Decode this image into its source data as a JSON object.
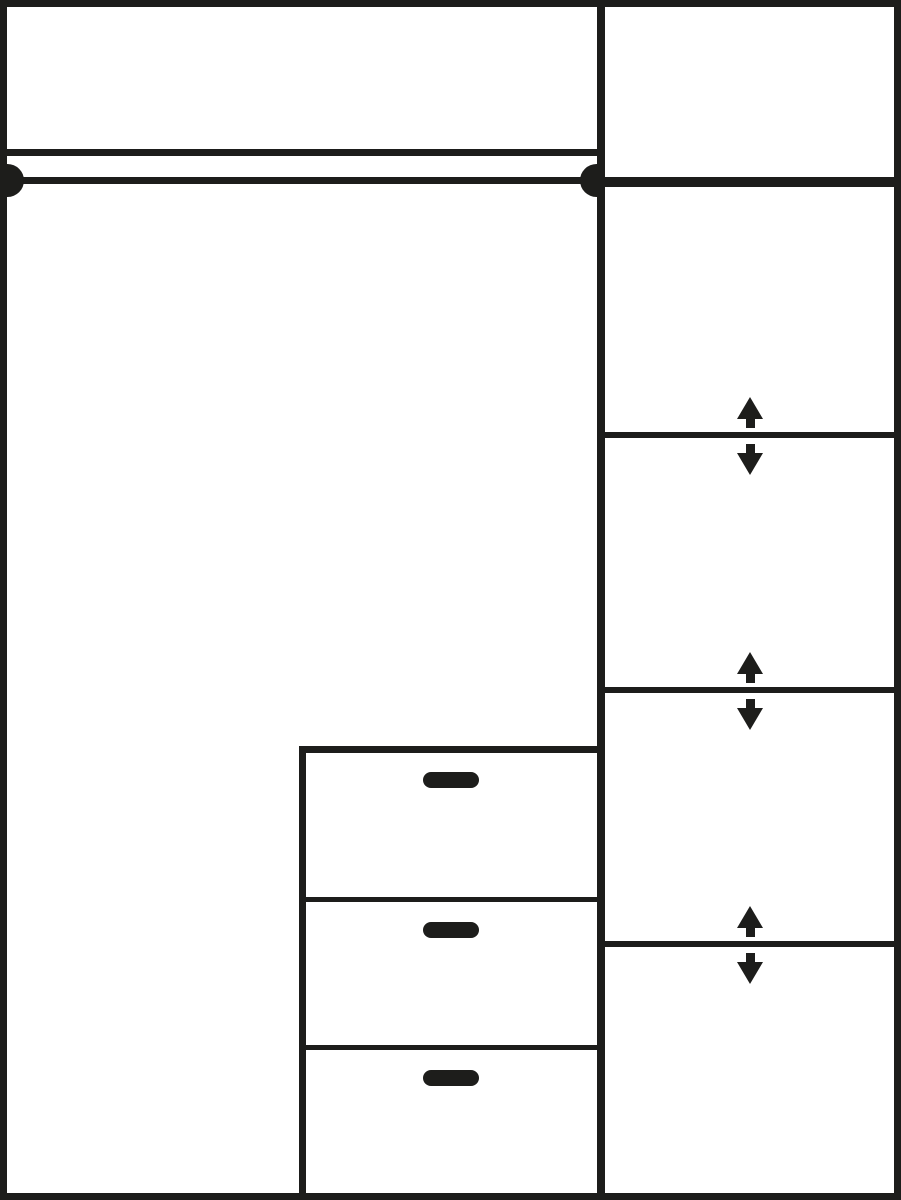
{
  "colors": {
    "line": "#1d1d1b",
    "background": "#ffffff"
  },
  "diagram": {
    "type": "wardrobe-interior-schematic",
    "left_section": {
      "top_shelf_count": 1,
      "hanging_rail_count": 1,
      "rail_end_caps": 2,
      "drawer_unit": {
        "drawer_count": 3,
        "handle_count": 3
      }
    },
    "right_section": {
      "compartment_count": 5,
      "fixed_shelf_count": 1,
      "adjustable_shelf_count": 3,
      "adjustable_indicator_pairs": 3
    },
    "icons": {
      "up_arrow_glyph": "▲",
      "down_arrow_glyph": "▼"
    }
  }
}
